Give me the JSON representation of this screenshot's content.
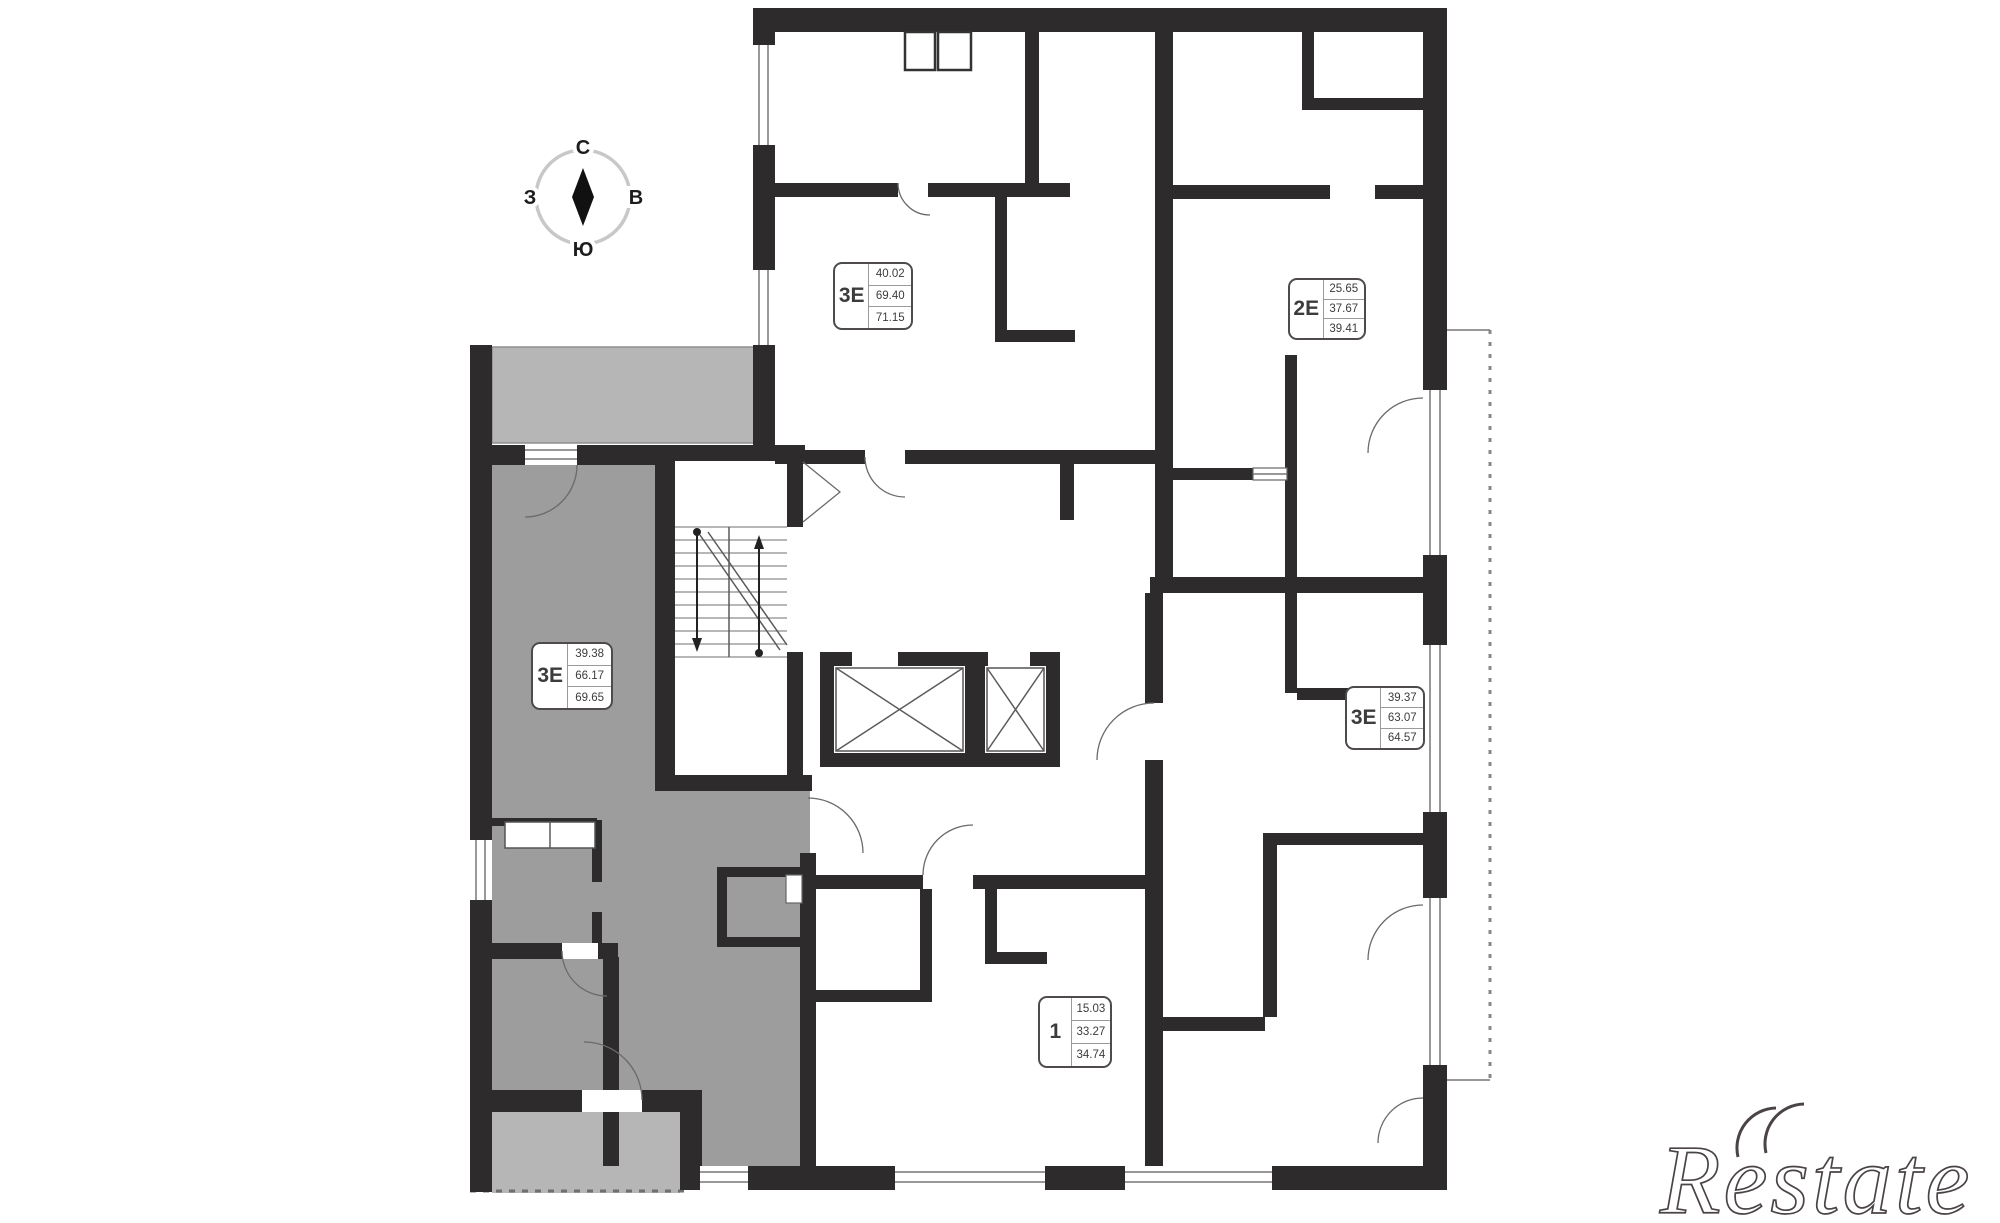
{
  "compass": {
    "north": "С",
    "south": "Ю",
    "west": "З",
    "east": "В"
  },
  "apartments": [
    {
      "id": "top-left",
      "type": "3Е",
      "area_upper": "40.02",
      "area_living": "69.40",
      "area_total": "71.15",
      "highlighted": false
    },
    {
      "id": "top-right",
      "type": "2Е",
      "area_upper": "25.65",
      "area_living": "37.67",
      "area_total": "39.41",
      "highlighted": false
    },
    {
      "id": "left-selected",
      "type": "3Е",
      "area_upper": "39.38",
      "area_living": "66.17",
      "area_total": "69.65",
      "highlighted": true
    },
    {
      "id": "right-middle",
      "type": "3Е",
      "area_upper": "39.37",
      "area_living": "63.07",
      "area_total": "64.57",
      "highlighted": false
    },
    {
      "id": "bottom-center",
      "type": "1",
      "area_upper": "15.03",
      "area_living": "33.27",
      "area_total": "34.74",
      "highlighted": false
    }
  ],
  "watermark": {
    "text": "Restate"
  },
  "colors": {
    "wall": "#2e2b2c",
    "highlight": "#9d9d9d",
    "balcony": "#b6b6b6",
    "badge_border": "#4f4b4b",
    "watermark": "#4a4347"
  }
}
